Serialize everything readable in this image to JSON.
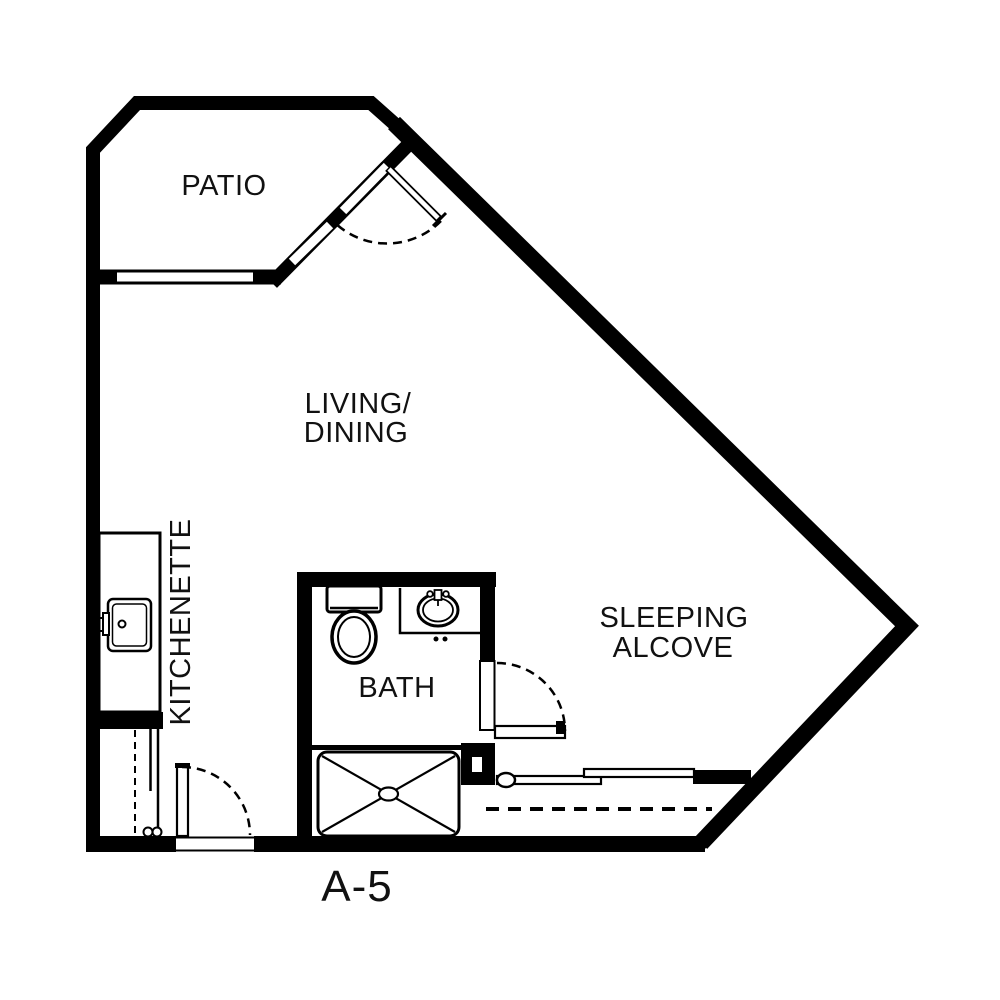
{
  "plan": {
    "title": "A-5",
    "background_color": "#ffffff",
    "wall_color": "#000000",
    "rooms": {
      "patio": {
        "label": "PATIO"
      },
      "living_dining": {
        "lines": [
          "LIVING/",
          "DINING"
        ]
      },
      "kitchenette": {
        "label": "KITCHENETTE"
      },
      "bath": {
        "label": "BATH"
      },
      "sleeping_alcove": {
        "lines": [
          "SLEEPING",
          "ALCOVE"
        ]
      }
    },
    "fixtures": {
      "kitchen_sink": "kitchen-sink-icon",
      "toilet": "toilet-icon",
      "bath_sink": "bath-sink-icon",
      "shower": "shower-icon"
    },
    "doors": [
      "patio-door",
      "bath-door",
      "entry-door"
    ],
    "closets": [
      "entry-closet",
      "alcove-closet"
    ]
  }
}
